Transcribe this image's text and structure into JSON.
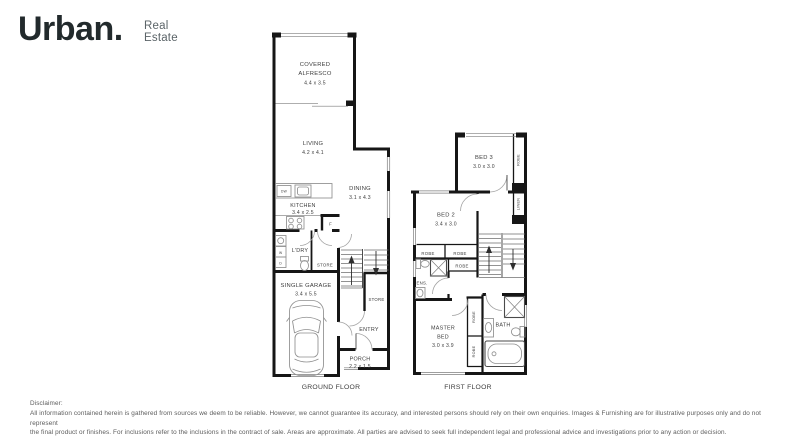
{
  "logo": {
    "brand": "Urban.",
    "tagline_top": "Real",
    "tagline_bottom": "Estate"
  },
  "ground_floor": {
    "label": "GROUND FLOOR",
    "alfresco_name1": "COVERED",
    "alfresco_name2": "ALFRESCO",
    "alfresco_dims": "4.4 x 3.5",
    "living_name": "LIVING",
    "living_dims": "4.2 x 4.1",
    "dining_name": "DINING",
    "dining_dims": "3.1 x 4.3",
    "kitchen_name": "KITCHEN",
    "kitchen_dims": "3.4 x 2.5",
    "ldry_name": "L'DRY",
    "store_understairs": "STORE",
    "store_entry": "STORE",
    "garage_name": "SINGLE GARAGE",
    "garage_dims": "3.4 x 5.5",
    "entry_name": "ENTRY",
    "porch_name": "PORCH",
    "porch_dims": "2.2 x 1.5",
    "appliance_dw": "DW",
    "appliance_f": "F",
    "appliance_w": "W",
    "appliance_d": "D"
  },
  "first_floor": {
    "label": "FIRST FLOOR",
    "bed3_name": "BED 3",
    "bed3_dims": "3.0 x 3.0",
    "bed3_robe": "ROBE",
    "linen": "LINEN",
    "bed2_name": "BED 2",
    "bed2_dims": "3.4 x 3.0",
    "bed2_robe1": "ROBE",
    "bed2_robe2": "ROBE",
    "hall_robe": "ROBE",
    "ens_name": "ENS.",
    "master_name1": "MASTER",
    "master_name2": "BED",
    "master_dims": "3.0 x 3.9",
    "master_robe1": "ROBE",
    "master_robe2": "ROBE",
    "bath_name": "BATH"
  },
  "disclaimer": {
    "title": "Disclaimer:",
    "line1": "All information contained herein is gathered from sources we deem to be reliable. However, we cannot guarantee its accuracy, and interested persons should rely on their own enquiries. Images & Furnishing are for illustrative purposes only and do not represent",
    "line2": "the final product or finishes. For inclusions refer to the inclusions in the contract of sale. Areas are approximate. All parties are advised to seek full independent legal and professional advice and investigations prior to any action or decision."
  },
  "colors": {
    "wall": "#161616",
    "label_text": "#3c3c3c",
    "logo_dark": "#222a2c",
    "logo_gray": "#5b6468",
    "disclaimer_text": "#5c5c5c"
  }
}
